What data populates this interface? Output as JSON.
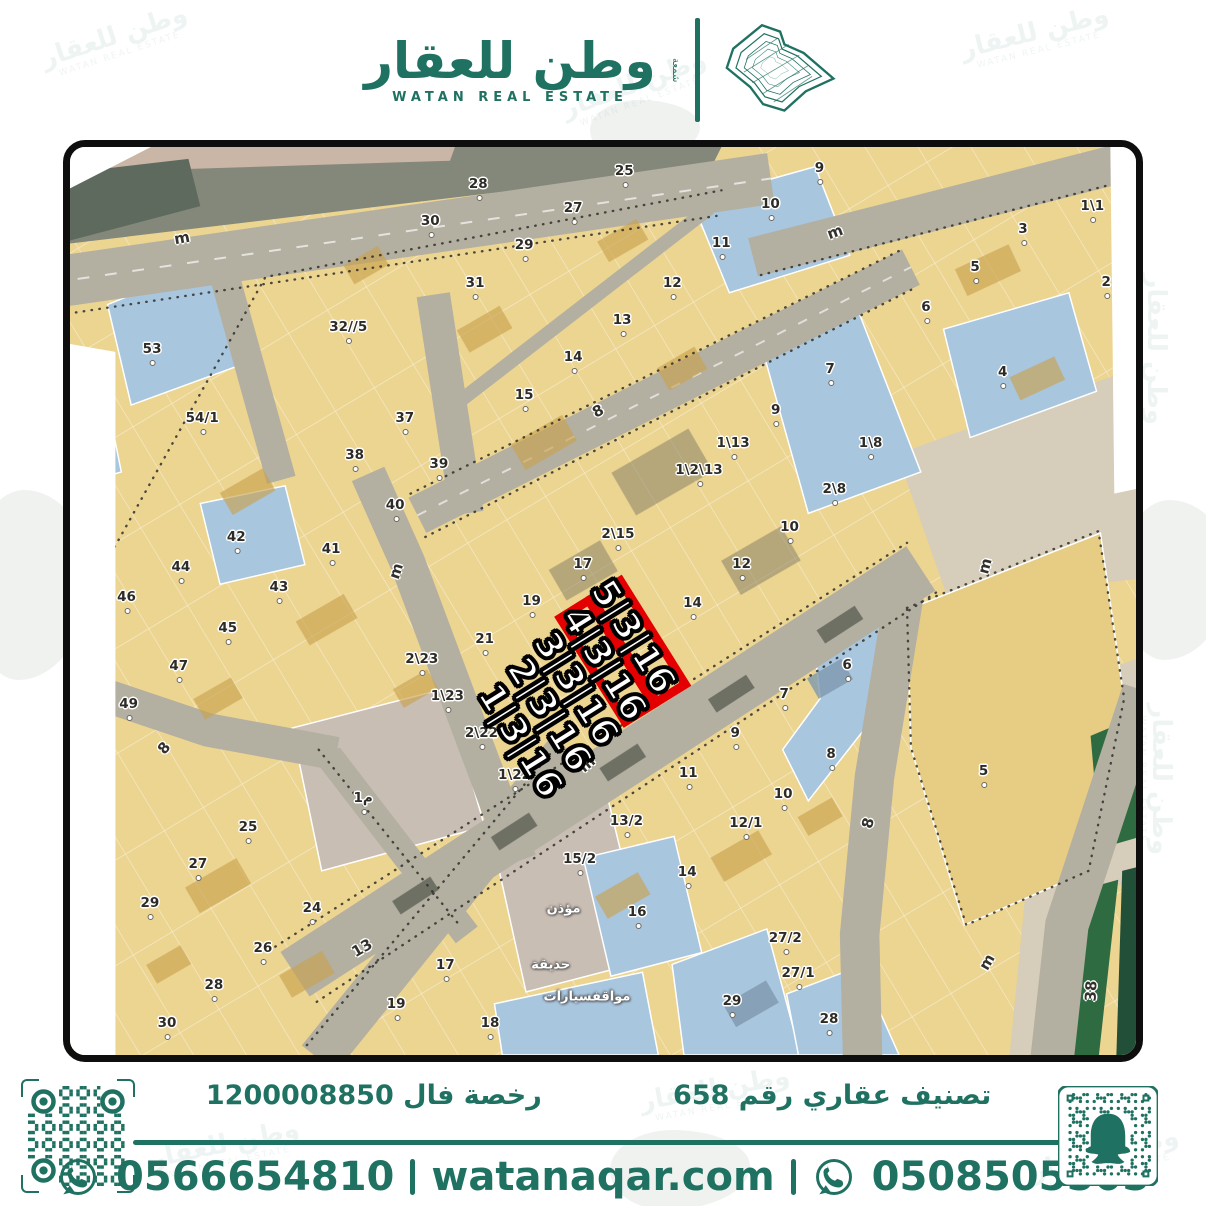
{
  "brand": {
    "name_ar": "وطن للعقار",
    "name_en": "WATAN REAL ESTATE",
    "side_text": "شمعة",
    "color": "#1f7161",
    "logo_icon": "saudi-map-contours-icon"
  },
  "footer": {
    "classification": "تصنيف عقاري رقم 658",
    "license": "رخصة فال 1200008850",
    "phone_left": "0566654810",
    "website": "watanaqar.com",
    "phone_right": "0508505505",
    "whatsapp_icon": "whatsapp-icon",
    "qr_left_icon": "qr-code",
    "qr_right_icon": "snapchat-snapcode"
  },
  "map": {
    "colors": {
      "parcel_tan": "#ecd491",
      "parcel_blue": "#a9c6df",
      "parcel_gray": "#c9beb4",
      "road": "#b3afa1",
      "sand": "#d6cdba",
      "green": "#2e6b41",
      "highlight_red": "#e40000"
    },
    "highlights": [
      {
        "t": "5|3|16",
        "x": 52.8,
        "y": 54.0,
        "r": 58
      },
      {
        "t": "4|3|16",
        "x": 50.1,
        "y": 56.9,
        "r": 58
      },
      {
        "t": "3|3|16",
        "x": 47.5,
        "y": 59.7,
        "r": 58
      },
      {
        "t": "2|3|16",
        "x": 44.9,
        "y": 62.6,
        "r": 58
      },
      {
        "t": "1|3|16",
        "x": 42.2,
        "y": 65.4,
        "r": 58
      }
    ],
    "streets": [
      {
        "t": "m",
        "x": 10.5,
        "y": 10.0,
        "r": -10
      },
      {
        "t": "8",
        "x": 49.5,
        "y": 29.1,
        "r": -27
      },
      {
        "t": "m",
        "x": 71.8,
        "y": 9.4,
        "r": -20
      },
      {
        "t": "m",
        "x": 30.6,
        "y": 46.7,
        "r": -72
      },
      {
        "t": "8",
        "x": 8.8,
        "y": 66.2,
        "r": -50
      },
      {
        "t": "m",
        "x": 48.5,
        "y": 68.0,
        "r": -40
      },
      {
        "t": "8",
        "x": 74.9,
        "y": 74.5,
        "r": -75
      },
      {
        "t": "13",
        "x": 27.4,
        "y": 88.2,
        "r": -30
      },
      {
        "t": "m",
        "x": 86.0,
        "y": 89.8,
        "r": -60
      },
      {
        "t": "38",
        "x": 95.8,
        "y": 92.9,
        "r": -87
      },
      {
        "t": "m",
        "x": 85.8,
        "y": 46.1,
        "r": -75
      }
    ],
    "areas": [
      {
        "t": "مؤذن",
        "x": 46.3,
        "y": 83.9,
        "r": 0
      },
      {
        "t": "حديقة",
        "x": 45.1,
        "y": 90.1,
        "r": 0
      },
      {
        "t": "مواقفسيارات",
        "x": 48.5,
        "y": 93.6,
        "r": 0
      }
    ],
    "parcels": [
      {
        "t": "25",
        "x": 52.0,
        "y": 2.6
      },
      {
        "t": "28",
        "x": 38.3,
        "y": 4.1
      },
      {
        "t": "27",
        "x": 47.2,
        "y": 6.7
      },
      {
        "t": "30",
        "x": 33.8,
        "y": 8.2
      },
      {
        "t": "10",
        "x": 65.7,
        "y": 6.3
      },
      {
        "t": "29",
        "x": 42.6,
        "y": 10.8
      },
      {
        "t": "11",
        "x": 61.1,
        "y": 10.6
      },
      {
        "t": "31",
        "x": 38.0,
        "y": 15.0
      },
      {
        "t": "12",
        "x": 56.5,
        "y": 15.0
      },
      {
        "t": "13",
        "x": 51.8,
        "y": 19.1
      },
      {
        "t": "14",
        "x": 47.2,
        "y": 23.1
      },
      {
        "t": "15",
        "x": 42.6,
        "y": 27.3
      },
      {
        "t": "9",
        "x": 66.2,
        "y": 29.0
      },
      {
        "t": "1\\13",
        "x": 62.2,
        "y": 32.6
      },
      {
        "t": "1\\2\\13",
        "x": 59.0,
        "y": 35.6
      },
      {
        "t": "9",
        "x": 70.3,
        "y": 2.3
      },
      {
        "t": "1\\1",
        "x": 95.9,
        "y": 6.5
      },
      {
        "t": "3",
        "x": 89.4,
        "y": 9.0
      },
      {
        "t": "5",
        "x": 84.9,
        "y": 13.2
      },
      {
        "t": "6",
        "x": 80.3,
        "y": 17.6
      },
      {
        "t": "2",
        "x": 97.2,
        "y": 14.9
      },
      {
        "t": "7",
        "x": 71.3,
        "y": 24.5
      },
      {
        "t": "4",
        "x": 87.5,
        "y": 24.8
      },
      {
        "t": "1\\8",
        "x": 75.1,
        "y": 32.6
      },
      {
        "t": "53",
        "x": 7.7,
        "y": 22.3
      },
      {
        "t": "32//5",
        "x": 26.1,
        "y": 19.8
      },
      {
        "t": "54/1",
        "x": 12.4,
        "y": 29.8
      },
      {
        "t": "37",
        "x": 31.4,
        "y": 29.9
      },
      {
        "t": "38",
        "x": 26.7,
        "y": 33.9
      },
      {
        "t": "39",
        "x": 34.6,
        "y": 34.9
      },
      {
        "t": "40",
        "x": 30.5,
        "y": 39.4
      },
      {
        "t": "42",
        "x": 15.6,
        "y": 42.9
      },
      {
        "t": "41",
        "x": 24.5,
        "y": 44.3
      },
      {
        "t": "44",
        "x": 10.4,
        "y": 46.3
      },
      {
        "t": "43",
        "x": 19.6,
        "y": 48.5
      },
      {
        "t": "46",
        "x": 5.3,
        "y": 49.6
      },
      {
        "t": "45",
        "x": 14.8,
        "y": 53.0
      },
      {
        "t": "47",
        "x": 10.2,
        "y": 57.2
      },
      {
        "t": "2\\23",
        "x": 33.0,
        "y": 56.4
      },
      {
        "t": "1\\23",
        "x": 35.4,
        "y": 60.5
      },
      {
        "t": "49",
        "x": 5.5,
        "y": 61.3
      },
      {
        "t": "2\\15",
        "x": 51.4,
        "y": 42.6
      },
      {
        "t": "2\\8",
        "x": 71.7,
        "y": 37.7
      },
      {
        "t": "10",
        "x": 67.5,
        "y": 41.8
      },
      {
        "t": "17",
        "x": 48.1,
        "y": 45.9
      },
      {
        "t": "12",
        "x": 63.0,
        "y": 45.9
      },
      {
        "t": "19",
        "x": 43.3,
        "y": 50.0
      },
      {
        "t": "14",
        "x": 58.4,
        "y": 50.2
      },
      {
        "t": "21",
        "x": 38.9,
        "y": 54.2
      },
      {
        "t": "2\\22",
        "x": 38.6,
        "y": 64.5
      },
      {
        "t": "1\\22",
        "x": 41.7,
        "y": 69.2
      },
      {
        "t": "6",
        "x": 72.9,
        "y": 57.0
      },
      {
        "t": "7",
        "x": 67.0,
        "y": 60.2
      },
      {
        "t": "9",
        "x": 62.4,
        "y": 64.5
      },
      {
        "t": "8",
        "x": 71.4,
        "y": 66.9
      },
      {
        "t": "11",
        "x": 58.0,
        "y": 68.9
      },
      {
        "t": "10",
        "x": 66.9,
        "y": 71.3
      },
      {
        "t": "13/2",
        "x": 52.2,
        "y": 74.2
      },
      {
        "t": "12/1",
        "x": 63.4,
        "y": 74.4
      },
      {
        "t": "15/2",
        "x": 47.8,
        "y": 78.4
      },
      {
        "t": "14",
        "x": 57.9,
        "y": 79.9
      },
      {
        "t": "5",
        "x": 85.7,
        "y": 68.7
      },
      {
        "t": "16",
        "x": 53.2,
        "y": 84.2
      },
      {
        "t": "1م",
        "x": 27.5,
        "y": 71.7
      },
      {
        "t": "25",
        "x": 16.7,
        "y": 74.9
      },
      {
        "t": "27",
        "x": 12.0,
        "y": 79.0
      },
      {
        "t": "29",
        "x": 7.5,
        "y": 83.3
      },
      {
        "t": "24",
        "x": 22.7,
        "y": 83.8
      },
      {
        "t": "26",
        "x": 18.1,
        "y": 88.2
      },
      {
        "t": "17",
        "x": 35.2,
        "y": 90.1
      },
      {
        "t": "28",
        "x": 13.5,
        "y": 92.3
      },
      {
        "t": "19",
        "x": 30.6,
        "y": 94.4
      },
      {
        "t": "30",
        "x": 9.1,
        "y": 96.5
      },
      {
        "t": "18",
        "x": 39.4,
        "y": 96.5
      },
      {
        "t": "27/2",
        "x": 67.1,
        "y": 87.1
      },
      {
        "t": "27/1",
        "x": 68.3,
        "y": 91.0
      },
      {
        "t": "29",
        "x": 62.1,
        "y": 94.1
      },
      {
        "t": "28",
        "x": 71.2,
        "y": 96.0
      }
    ]
  },
  "watermarks": [
    {
      "x": 40,
      "y": 22,
      "r": -18
    },
    {
      "x": 960,
      "y": 18,
      "r": -14
    },
    {
      "x": 1075,
      "y": 330,
      "r": 90
    },
    {
      "x": 18,
      "y": 330,
      "r": 90
    },
    {
      "x": 150,
      "y": 1130,
      "r": -12
    },
    {
      "x": 640,
      "y": 1075,
      "r": -10
    },
    {
      "x": 1030,
      "y": 1140,
      "r": -14
    },
    {
      "x": 560,
      "y": 70,
      "r": -20
    },
    {
      "x": 18,
      "y": 700,
      "r": 90
    },
    {
      "x": 1080,
      "y": 760,
      "r": 90
    }
  ]
}
